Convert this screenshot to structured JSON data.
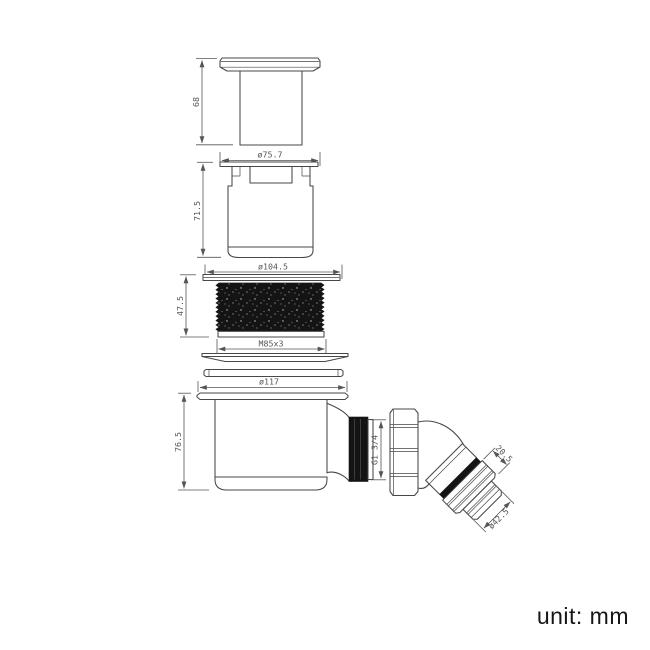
{
  "colors": {
    "bg": "#ffffff",
    "line": "#474747",
    "dim": "#555555",
    "dark": "#141414",
    "text": "#161616"
  },
  "dimensions": {
    "cap_height": "68",
    "cap_diameter": "ø75.7",
    "body_height": "71.5",
    "flange_diameter": "ø104.5",
    "collar_height": "47.5",
    "collar_thread": "M85x3",
    "trap_diameter": "ø117",
    "trap_height": "76.5",
    "outlet_thread": "G1 3/4",
    "elbow_nut_length": "20.5",
    "elbow_outlet_diameter": "ø42.5"
  },
  "footer": {
    "unit_label": "unit: mm"
  }
}
